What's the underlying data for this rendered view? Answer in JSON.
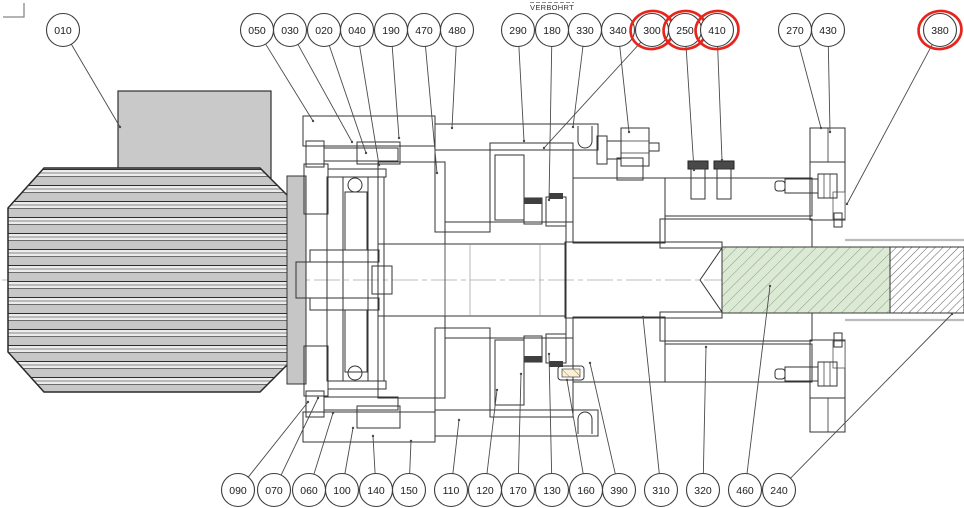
{
  "annotation": {
    "verbohrt_label": "VERBOHRT"
  },
  "colors": {
    "housing_gray": "#bdbdbd",
    "motor_gray": "#c7c7c7",
    "coupling_blue": "#b7c6e8",
    "brake_red": "#f6cfcf",
    "sleeve_tan": "#faf1d7",
    "shaft_green": "#dcead5",
    "marker_red": "#e7251d",
    "line_black": "#333333"
  },
  "balloon_style": {
    "radius": 16.5,
    "top_cy": 30,
    "bottom_cy": 490
  },
  "balloons": {
    "top": [
      {
        "label": "010",
        "x": 63,
        "tx": 120,
        "ty": 127
      },
      {
        "label": "050",
        "x": 257,
        "tx": 313,
        "ty": 121
      },
      {
        "label": "030",
        "x": 290,
        "tx": 352,
        "ty": 142
      },
      {
        "label": "020",
        "x": 324,
        "tx": 366,
        "ty": 153
      },
      {
        "label": "040",
        "x": 357,
        "tx": 379,
        "ty": 165
      },
      {
        "label": "190",
        "x": 391,
        "tx": 399,
        "ty": 138
      },
      {
        "label": "470",
        "x": 424,
        "tx": 437,
        "ty": 173
      },
      {
        "label": "480",
        "x": 457,
        "tx": 452,
        "ty": 128
      },
      {
        "label": "290",
        "x": 518,
        "tx": 524,
        "ty": 141
      },
      {
        "label": "180",
        "x": 552,
        "tx": 549,
        "ty": 200
      },
      {
        "label": "330",
        "x": 585,
        "tx": 573,
        "ty": 127
      },
      {
        "label": "340",
        "x": 618,
        "tx": 629,
        "ty": 132
      },
      {
        "label": "300",
        "x": 652,
        "tx": 544,
        "ty": 148,
        "red": true
      },
      {
        "label": "250",
        "x": 685,
        "tx": 694,
        "ty": 170,
        "red": true
      },
      {
        "label": "410",
        "x": 717,
        "tx": 722,
        "ty": 160,
        "red": true
      },
      {
        "label": "270",
        "x": 795,
        "tx": 821,
        "ty": 128
      },
      {
        "label": "430",
        "x": 828,
        "tx": 830,
        "ty": 132
      },
      {
        "label": "380",
        "x": 940,
        "tx": 847,
        "ty": 204,
        "red": true
      }
    ],
    "bottom": [
      {
        "label": "090",
        "x": 238,
        "tx": 308,
        "ty": 402
      },
      {
        "label": "070",
        "x": 274,
        "tx": 318,
        "ty": 398
      },
      {
        "label": "060",
        "x": 309,
        "tx": 333,
        "ty": 413
      },
      {
        "label": "100",
        "x": 342,
        "tx": 353,
        "ty": 428
      },
      {
        "label": "140",
        "x": 376,
        "tx": 373,
        "ty": 436
      },
      {
        "label": "150",
        "x": 409,
        "tx": 411,
        "ty": 441
      },
      {
        "label": "110",
        "x": 451,
        "tx": 459,
        "ty": 420
      },
      {
        "label": "120",
        "x": 485,
        "tx": 497,
        "ty": 390
      },
      {
        "label": "170",
        "x": 518,
        "tx": 521,
        "ty": 374
      },
      {
        "label": "130",
        "x": 552,
        "tx": 549,
        "ty": 354
      },
      {
        "label": "160",
        "x": 586,
        "tx": 567,
        "ty": 380
      },
      {
        "label": "390",
        "x": 619,
        "tx": 590,
        "ty": 363
      },
      {
        "label": "310",
        "x": 661,
        "tx": 643,
        "ty": 317
      },
      {
        "label": "320",
        "x": 703,
        "tx": 706,
        "ty": 347
      },
      {
        "label": "460",
        "x": 745,
        "tx": 770,
        "ty": 286
      },
      {
        "label": "240",
        "x": 779,
        "tx": 952,
        "ty": 314
      }
    ]
  }
}
